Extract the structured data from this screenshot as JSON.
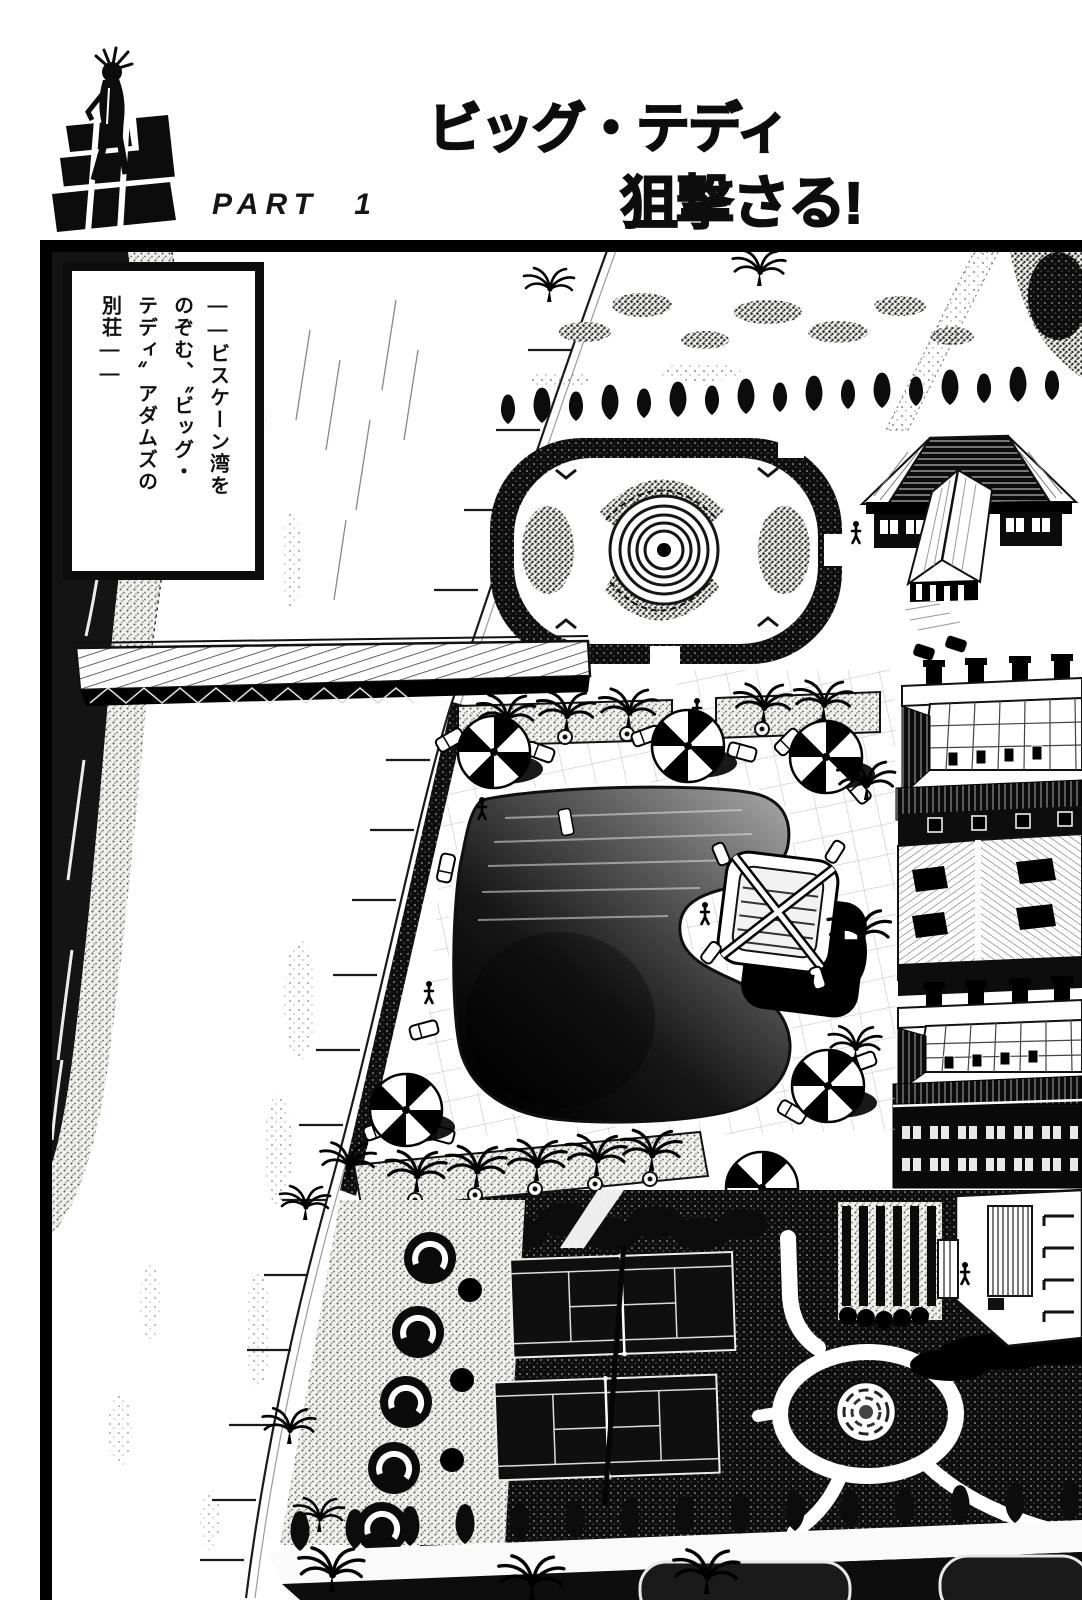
{
  "header": {
    "logo_label": "golgo-13-series-logo",
    "part_label": "PART 1",
    "title_line1": "ビッグ・テディ",
    "title_line2": "狙撃さる!"
  },
  "caption": {
    "text": "――ビスケーン湾を\nのぞむ、〝ビッグ・\nテディ〟アダムズの\n別荘――"
  },
  "colors": {
    "ink": "#0e0e0e",
    "paper": "#ffffff"
  }
}
